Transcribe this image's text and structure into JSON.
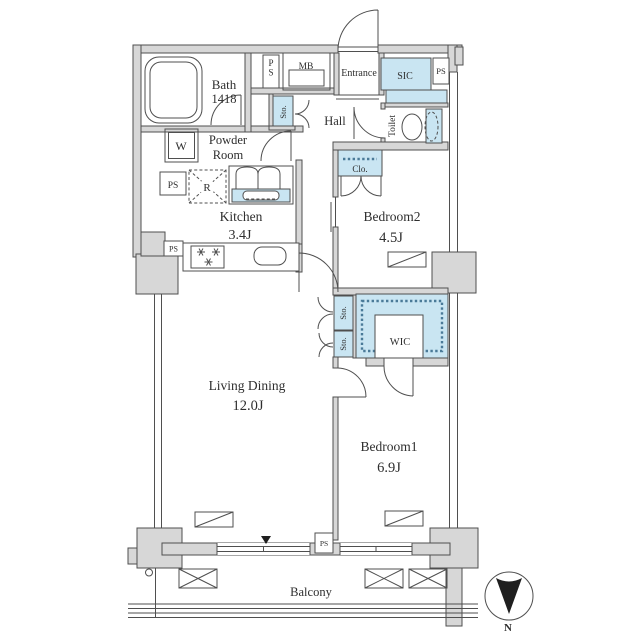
{
  "plan": {
    "rooms": {
      "bath": {
        "label": "Bath",
        "size": "1418"
      },
      "powder_room": {
        "label_line1": "Powder",
        "label_line2": "Room"
      },
      "kitchen": {
        "label": "Kitchen",
        "size": "3.4J"
      },
      "living_dining": {
        "label": "Living Dining",
        "size": "12.0J"
      },
      "bedroom1": {
        "label": "Bedroom1",
        "size": "6.9J"
      },
      "bedroom2": {
        "label": "Bedroom2",
        "size": "4.5J"
      },
      "entrance": {
        "label": "Entrance"
      },
      "hall": {
        "label": "Hall"
      },
      "toilet": {
        "label": "Toilet"
      },
      "balcony": {
        "label": "Balcony"
      }
    },
    "storage": {
      "sic": {
        "label": "SIC"
      },
      "wic": {
        "label": "WIC"
      },
      "closet": {
        "label": "Clo."
      },
      "sto_hall": {
        "label": "Sto."
      },
      "sto_upper": {
        "label": "Sto."
      },
      "sto_lower": {
        "label": "Sto."
      }
    },
    "equipment": {
      "washer": {
        "label": "W"
      },
      "refrigerator": {
        "label": "R"
      },
      "meter_box": {
        "label": "MB"
      },
      "pipe_shafts": {
        "top": "PS",
        "entry_side": "PS",
        "powder": "PS",
        "kitchen": "PS",
        "balcony": "PS"
      }
    },
    "compass": {
      "north": "N"
    },
    "colors": {
      "wall_fill": "#d7d7d7",
      "storage_fill": "#c9e5f2",
      "line": "#4f4f4f",
      "text": "#2e2e2e",
      "accent_dot": "#4a7a98",
      "north": "#1f1f1f"
    }
  }
}
